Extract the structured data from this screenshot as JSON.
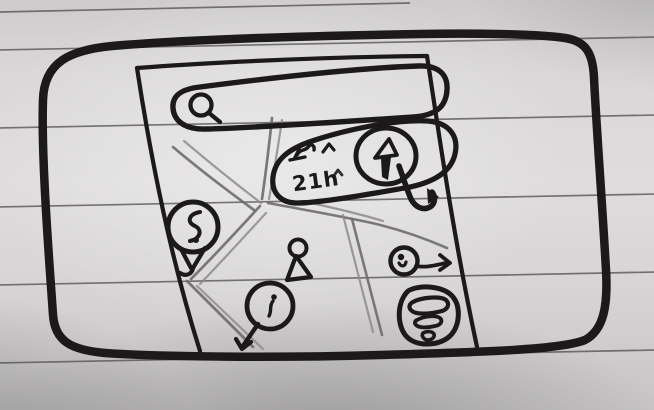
{
  "sketch": {
    "kind": "hand-drawn map app wireframe",
    "route_card": {
      "duration": "21h"
    },
    "search": {
      "value": "",
      "placeholder": ""
    },
    "icons": {
      "search": "magnifier-icon",
      "navigation": "navigate-arrow-icon",
      "route": "route-squiggle-icon",
      "price_pin": "s-pin-icon",
      "user": "person-marker-icon",
      "poi_pin": "small-pin-icon",
      "direction": "circle-right-arrow-icon",
      "layers": "layers-stack-icon",
      "drop_arrow": "down-hook-arrow-icon"
    },
    "colors": {
      "ink": "#1b191a",
      "road": "#6e6c6d",
      "paper": "#d7d5d6",
      "ruled_line": "#4f4d4e"
    }
  }
}
